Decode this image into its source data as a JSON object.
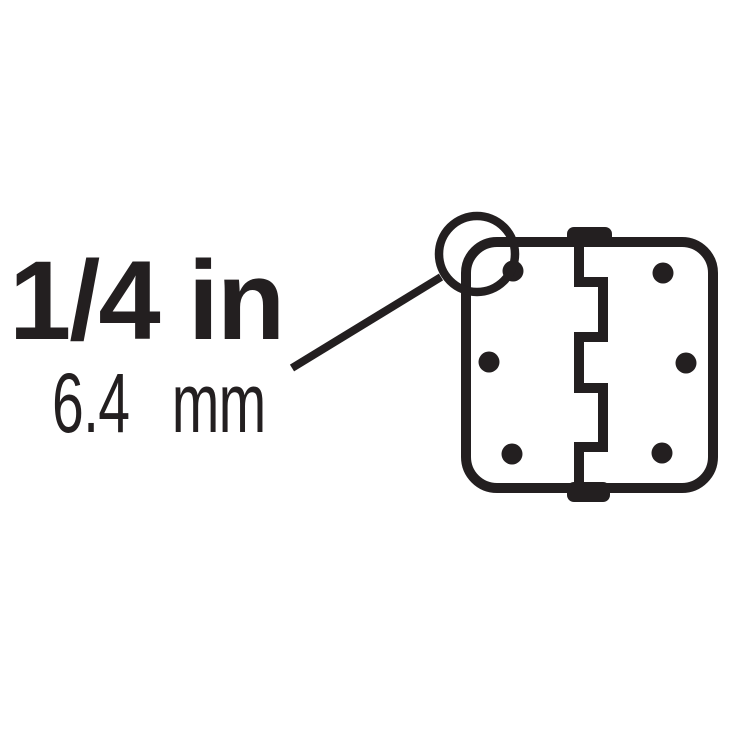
{
  "colors": {
    "ink": "#231f20",
    "background": "#ffffff"
  },
  "measurement": {
    "inches": "1/4 in",
    "millimeters": "6.4 mm"
  },
  "illustration": {
    "name": "door-hinge-front-view",
    "callout_target": "rounded-corner-radius",
    "screw_hole_count": "6"
  }
}
